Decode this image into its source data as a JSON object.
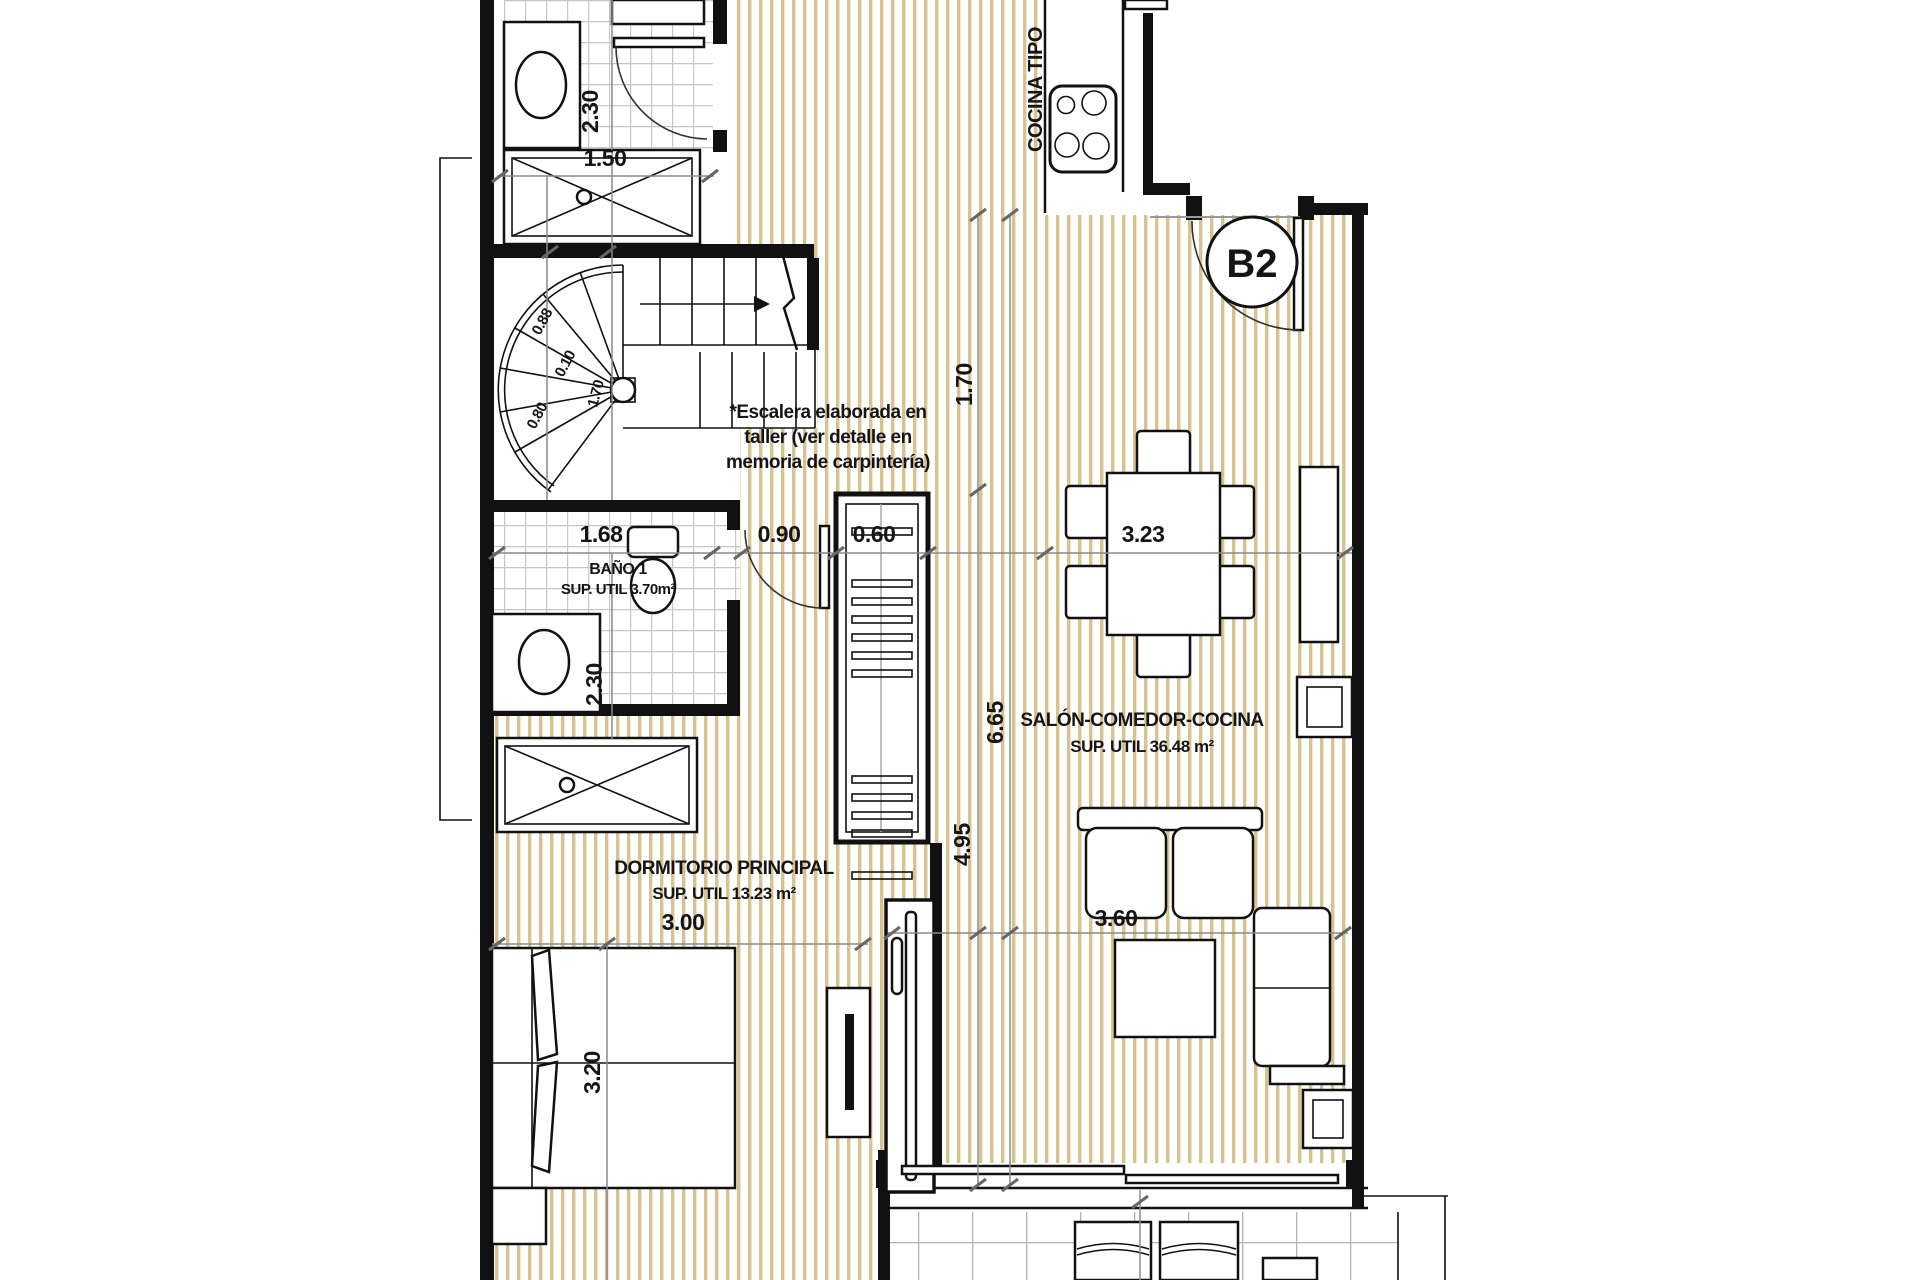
{
  "unit": {
    "label": "B2"
  },
  "rooms": {
    "cocina": {
      "label": "COCINA TIPO"
    },
    "bano1": {
      "name": "BAÑO 1",
      "area": "SUP. UTIL 3.70m²"
    },
    "salon": {
      "name": "SALÓN-COMEDOR-COCINA",
      "area": "SUP. UTIL 36.48 m²"
    },
    "dormitorio": {
      "name": "DORMITORIO PRINCIPAL",
      "area": "SUP. UTIL 13.23 m²"
    }
  },
  "stair_note": {
    "lines": [
      "*Escalera elaborada en",
      "taller (ver detalle en",
      "memoria de carpintería)"
    ]
  },
  "dimensions": {
    "bath_top_height": "2.30",
    "bath_top_width": "1.50",
    "stair_width_a": "0.88",
    "stair_gap": "0.10",
    "stair_center": "1.70",
    "stair_width_b": "0.80",
    "bano1_width": "1.68",
    "hall_width": "0.90",
    "closet_depth": "0.60",
    "bano1_height": "2.30",
    "kitchen_length": "1.70",
    "dining_width": "3.23",
    "salon_total_length": "6.65",
    "hall_length": "4.95",
    "bedroom_width": "3.00",
    "living_width": "3.60",
    "bedroom_length": "3.20"
  },
  "colors": {
    "wood_stripe": "#d8c28f",
    "bath_tile_grout": "#c6c6c6",
    "terrace_tile_grout": "#b3b3b3",
    "wall": "#111111",
    "dim_line": "#8a8a8a",
    "text": "#151515"
  }
}
